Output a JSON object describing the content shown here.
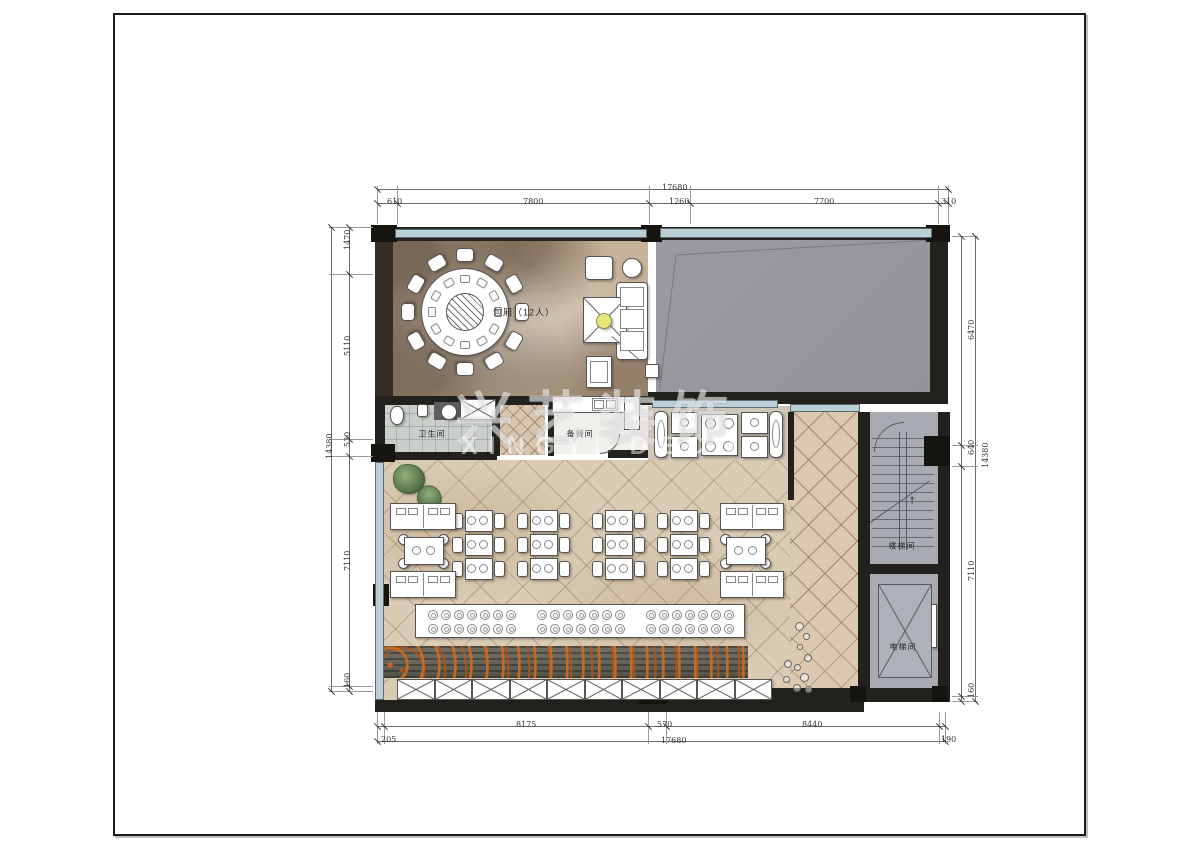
{
  "watermark": {
    "cn": "兴艺装饰",
    "en": "XINGYI DECO"
  },
  "rooms": {
    "private_room": "包厢（12人）",
    "restroom": "卫生间",
    "pantry": "备餐间",
    "stairwell": "楼梯间",
    "elevator": "电梯间"
  },
  "dimensions": {
    "top": {
      "total": "17680",
      "segments": [
        "610",
        "7800",
        "1260",
        "7700",
        "310"
      ]
    },
    "bottom": {
      "total": "17680",
      "segments": [
        "205",
        "8175",
        "570",
        "8440",
        "190"
      ]
    },
    "left": {
      "total": "14380",
      "segments": [
        "1470",
        "5110",
        "530",
        "7110",
        "160"
      ]
    },
    "right": {
      "total": "14380",
      "segments": [
        "6470",
        "640",
        "7110",
        "160"
      ]
    }
  },
  "colors": {
    "wall": "#23211e",
    "glazing": "#bad0d6",
    "gray_room": "#98989c",
    "hall_floor": "#dacbb4",
    "corridor_floor": "#dcc8b1",
    "accent_orange": "#c86a1e"
  }
}
